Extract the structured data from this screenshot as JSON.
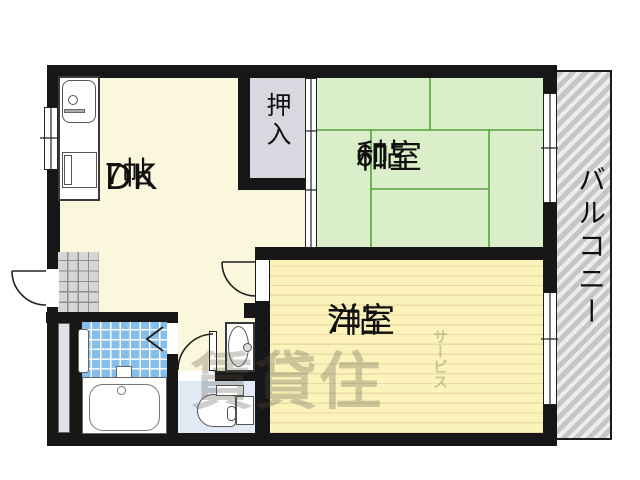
{
  "rooms": {
    "dk": {
      "name": "DK",
      "size": "7帖"
    },
    "washitsu": {
      "name": "和室",
      "size": "6帖"
    },
    "yoshitsu": {
      "name": "洋室",
      "size": "7帖"
    },
    "oshiire": {
      "name": "押入"
    },
    "balcony": {
      "name": "バルコニー"
    }
  },
  "watermark": {
    "main": "賃貸住",
    "sub": "サービス"
  },
  "colors": {
    "wall": "#171717",
    "dk": "#FBF7DC",
    "tatami": "#DAEEC9",
    "tatamiline": "#55A33B",
    "yoshitsu": "#FBF3BA",
    "floorline": "#EADCA4",
    "oshiire": "#DBD7E1",
    "toiletfloor": "#E1EAF5",
    "bathtile": "#85BEEB",
    "balcony": "#CBCBCB"
  }
}
